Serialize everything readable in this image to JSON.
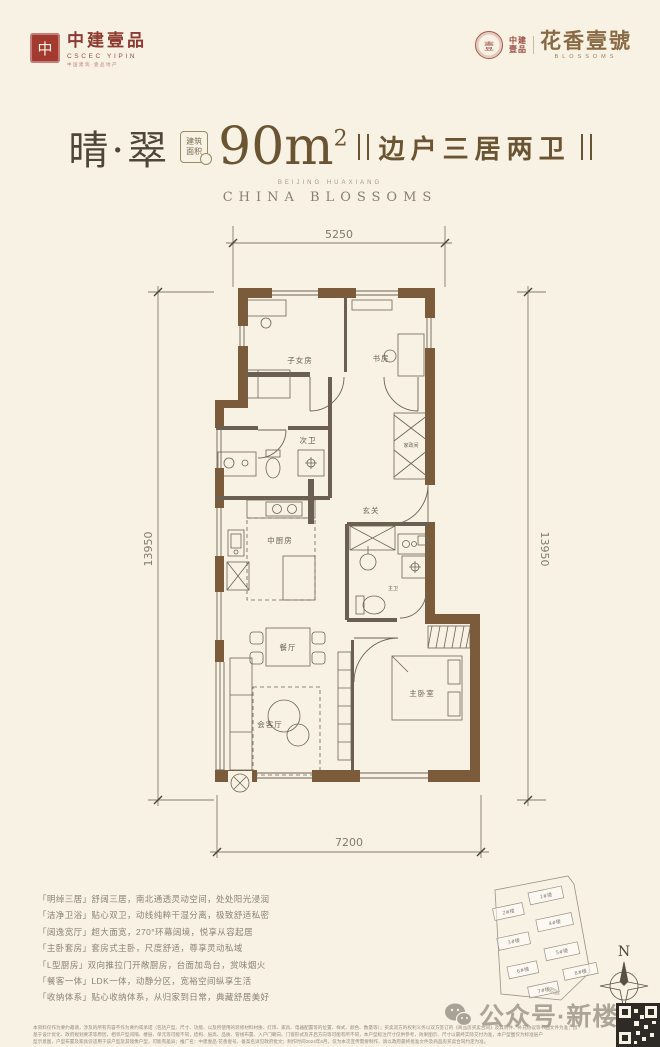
{
  "header": {
    "left_logo": {
      "seal_char": "中",
      "brand": "中建壹品",
      "sub": "CSCEC YIPIN",
      "tagline": "中国建筑·壹品地产"
    },
    "right_logo": {
      "seal_char": "壹",
      "brand_top": "中建",
      "brand_bottom": "壹品",
      "name": "花香壹號",
      "sub": "BLOSSOMS"
    }
  },
  "title": {
    "name": "晴·翠",
    "badge_top": "建筑",
    "badge_bottom": "面积",
    "area": "90m",
    "area_sup": "2",
    "tagline": "边户三居两卫",
    "sub_small": "BEIJING HUAXIANG",
    "sub": "CHINA BLOSSOMS"
  },
  "plan": {
    "dim_top": "5250",
    "dim_left": "13950",
    "dim_right": "13950",
    "dim_bottom": "7200",
    "rooms": {
      "children": "子女房",
      "study": "书房",
      "bath2": "次卫",
      "utility": "家政间",
      "foyer": "玄关",
      "kitchen": "中厨房",
      "dining": "餐厅",
      "living": "会客厅",
      "master_bath": "主卫",
      "master": "主卧室"
    }
  },
  "features": {
    "items": [
      "「明绰三居」舒阔三居，南北通透灵动空间，处处阳光浸润",
      "「洁净卫浴」贴心双卫，动线纯粹干湿分离，极致舒适私密",
      "「阔逸宽厅」超大面宽，270°环幕阔境，悦享从容起居",
      "「主卧套房」套房式主卧，尺度舒适，尊享灵动私域",
      "「L型厨房」双向推拉门开敞厨房，台面加岛台，赏味烟火",
      "「餐客一体」LDK一体，动静分区，宽裕空间纵享生活",
      "「收纳体系」贴心收纳体系，从归家到日常，典藏舒居美好"
    ]
  },
  "site": {
    "buildings": [
      "2#楼",
      "1#楼",
      "3#楼",
      "4#楼",
      "6#楼",
      "5#楼",
      "7#楼",
      "8#楼"
    ],
    "north": "N"
  },
  "footer": {
    "watermark": "公众号·新楼市",
    "disclaimer": [
      "本资料仅作为要约邀请，涉及的所有内容不作为要约或承诺（包括户型、尺寸、功能、以及所使用的装修材料材质、灯饰、家具、电器配置等的位置、样式、颜色、数量等）；买卖双方的权利义务以双方签订的《商品房买卖合同》及其附件、补充协议等书面文件为准；因",
      "基于设计优化、政府规划要求等原因，相邻户型间隔、楼层、单元等可能不同，结构、层高、品质、管线布置、入户门朝向、门窗形式及开启方向等可能有所不同，本户型标注尺寸仅供参考，效果图示、尺寸以最终实际交付为准，本户型图仅为标准层户",
      "型示意图，户型布置及家具仅适用于该户型及其镜像户型，可能有差异；推广名：中建壹品·花香壹号，备案名详见政府批文；制作时间2024年6月，仅为本次宣传需要制作，请以政府最终批准文件及商品房买卖合同约定为准。"
    ]
  }
}
